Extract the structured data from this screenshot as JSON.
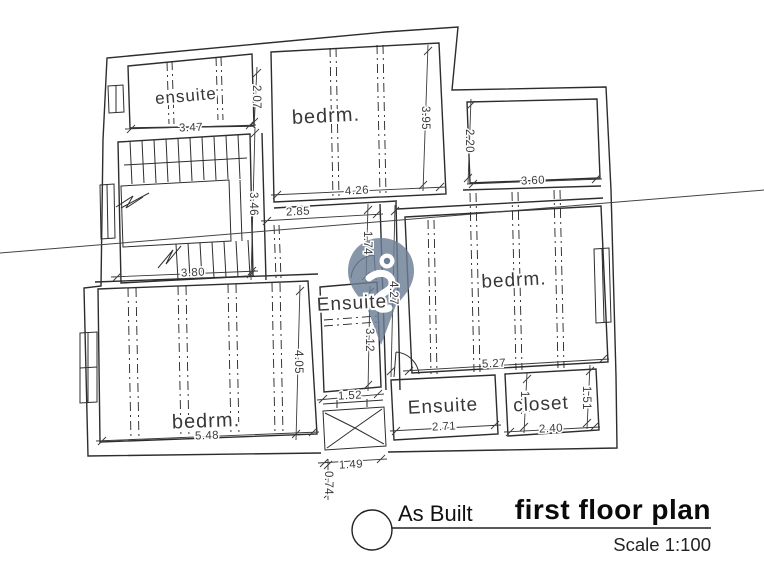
{
  "drawing": {
    "labels": {
      "ensuite_tl": "ensuite",
      "bedrm_top": "bedrm.",
      "ensuite_center": "Ensuite",
      "bedrm_right": "bedrm.",
      "bedrm_bottom_left": "bedrm.",
      "ensuite_bottom": "Ensuite",
      "closet": "closet"
    },
    "dims": {
      "d347": "3.47",
      "d207": "2.07",
      "d395": "3.95",
      "d426": "4.26",
      "d220": "2.20",
      "d360": "3.60",
      "d285": "2.85",
      "d174": "1.74",
      "d346": "3.46",
      "d380": "3.80",
      "d427": "4.27",
      "d527": "5.27",
      "d312": "3.12",
      "d152": "1.52",
      "d405": "4.05",
      "d548": "5.48",
      "d271": "2.71",
      "d151_ensuite": "1.51",
      "d240": "2.40",
      "d151_closet": "1.51",
      "d149": "1.49",
      "d074": "0.74"
    }
  },
  "title_block": {
    "phase": "As Built",
    "title": "first floor plan",
    "scale": "Scale 1:100"
  },
  "watermark": {
    "icon": "map-pin",
    "color": "#6b7e94"
  },
  "colors": {
    "line": "#2d2d2d",
    "dim": "#3a3a3a",
    "background": "#ffffff"
  }
}
